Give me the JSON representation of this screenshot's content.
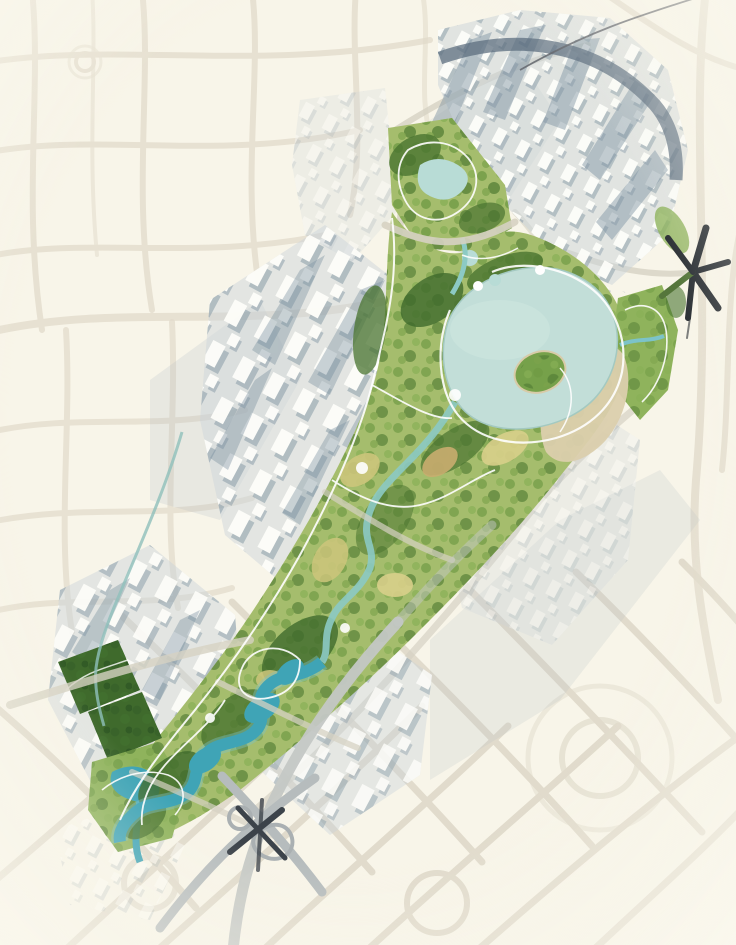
{
  "meta": {
    "type": "landscape-masterplan-aerial-rendering",
    "description": "Aerial masterplan rendering of a diagonal urban corridor with a central linear park, large lake, winding teal river, dense white building blocks with blue-grey shadows, faint surrounding street network on cream paper, a highway interchange at the bottom and a dark multi-arm road junction symbol at the right.",
    "visible_text": []
  },
  "map": {
    "background": "#f8f5e9",
    "palette": {
      "street": "#e2dbcb",
      "streetLight": "#eae4d6",
      "streetGhost": "#ddd7c7",
      "roadPale": "#d6d2c3",
      "roadAvenue": "#c4c8c5",
      "urbanWash": "#c9d3da",
      "urbanSoftShadow": "#b3bcc2",
      "buildingWhite": "#fdfdf9",
      "buildingShadow": "#8296a4",
      "shadowStreak": "#7b90a0",
      "darkBand": "#56687a",
      "railDark": "#63666c",
      "parkBase": "#a5bd6d",
      "parkStrip": "#8fb35c",
      "forest": "#4a7430",
      "forestDark": "#3f6a2c",
      "meadow": "#ccc57b",
      "meadowLight": "#d8cf8a",
      "terraceTan": "#c9ad6f",
      "sand": "#dbcfad",
      "lake": "#c2ded8",
      "lakeInner": "#cde6e0",
      "lakeShore": "#a3c9c1",
      "pond": "#b8dcd6",
      "streamPale": "#8ccac4",
      "river": "#3fa4b6",
      "riverGlow": "#7cc3c9",
      "canal": "#8fc0bb",
      "pathWhite": "#ffffff",
      "islandGreen": "#76a14a",
      "rampGray": "#b6bcbd",
      "rampLight": "#aab0b2",
      "roadDark": "#3c434a",
      "starDark": "#2c3136",
      "starGreen": "#55763b"
    },
    "features": [
      {
        "name": "background-street-network",
        "kind": "roads",
        "note": "faint beige street web fading to the corners"
      },
      {
        "name": "urban-district-top-right",
        "kind": "built-blocks",
        "note": "dense white blocks, long tower shadows, dark curved band"
      },
      {
        "name": "urban-district-mid-left",
        "kind": "built-blocks"
      },
      {
        "name": "urban-district-lower-left",
        "kind": "built-blocks"
      },
      {
        "name": "urban-district-mid-right",
        "kind": "built-blocks-ghosted"
      },
      {
        "name": "urban-district-lower-mid",
        "kind": "built-blocks"
      },
      {
        "name": "central-park-corridor",
        "kind": "park",
        "note": "diagonal linear park from lower-left to upper-right"
      },
      {
        "name": "upper-park-triangle",
        "kind": "park",
        "note": "triangular park with small pond"
      },
      {
        "name": "right-park-strip",
        "kind": "park"
      },
      {
        "name": "forest-blocks",
        "kind": "dark-tree-blocks"
      },
      {
        "name": "main-lake",
        "kind": "water",
        "note": "large pale lake with green island and sandy beach"
      },
      {
        "name": "upper-pond",
        "kind": "water"
      },
      {
        "name": "park-river",
        "kind": "water",
        "note": "vivid teal winding river in lower park"
      },
      {
        "name": "city-canal",
        "kind": "water",
        "note": "thin canal along streets west of corridor"
      },
      {
        "name": "footpath-network",
        "kind": "paths",
        "note": "white looping park paths"
      },
      {
        "name": "highway-interchange",
        "kind": "roads",
        "note": "crossing ramps with loops at bottom centre"
      },
      {
        "name": "road-junction-star",
        "kind": "symbol",
        "note": "dark asterisk-like junction with one green arm"
      },
      {
        "name": "elevated-road-band",
        "kind": "roads",
        "note": "dark curved band across the top-right district"
      },
      {
        "name": "roundabouts",
        "kind": "roads"
      }
    ]
  }
}
